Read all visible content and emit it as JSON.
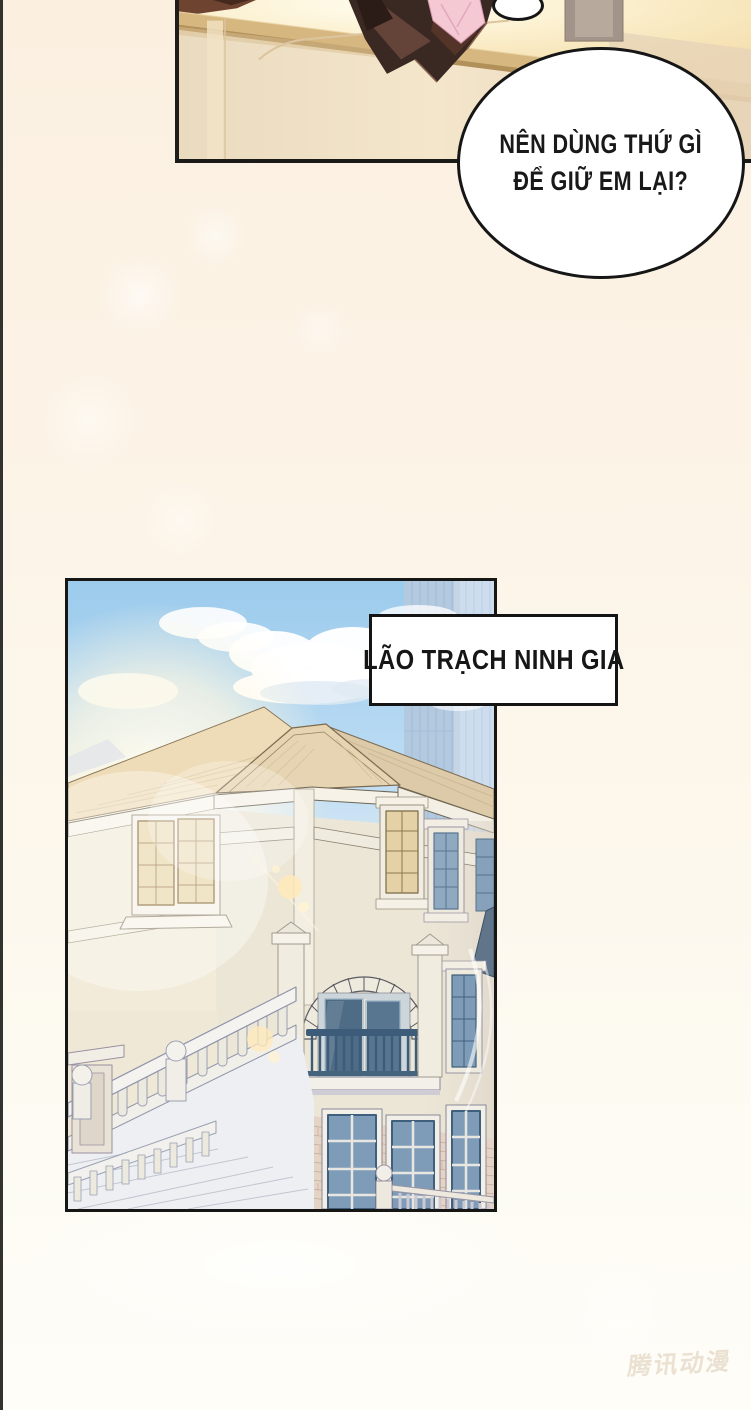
{
  "speech_bubble": {
    "line1": "NÊN DÙNG THỨ GÌ",
    "line2": "ĐỂ GIỮ EM LẠI?"
  },
  "caption_box": {
    "text": "LÃO TRẠCH NINH GIA"
  },
  "watermark": {
    "text": "腾讯动漫"
  },
  "colors": {
    "page_background_top": "#fbf0e0",
    "page_background_bottom": "#fefdf8",
    "panel_border": "#1a1a18",
    "bubble_border": "#161616",
    "sky_blue": "#9ccbec",
    "roof_tan": "#e6d4b2",
    "wall_cream": "#f2ebd9",
    "window_blue": "#7e9cb8",
    "lit_window_gold": "#ead7ab",
    "railing_blue": "#3c5c7a",
    "stone_tan": "#e5d6c8",
    "person_coat_brown": "#3a2822",
    "bow_pink": "#f4c9d4",
    "frame_gold": "#d6b780"
  }
}
